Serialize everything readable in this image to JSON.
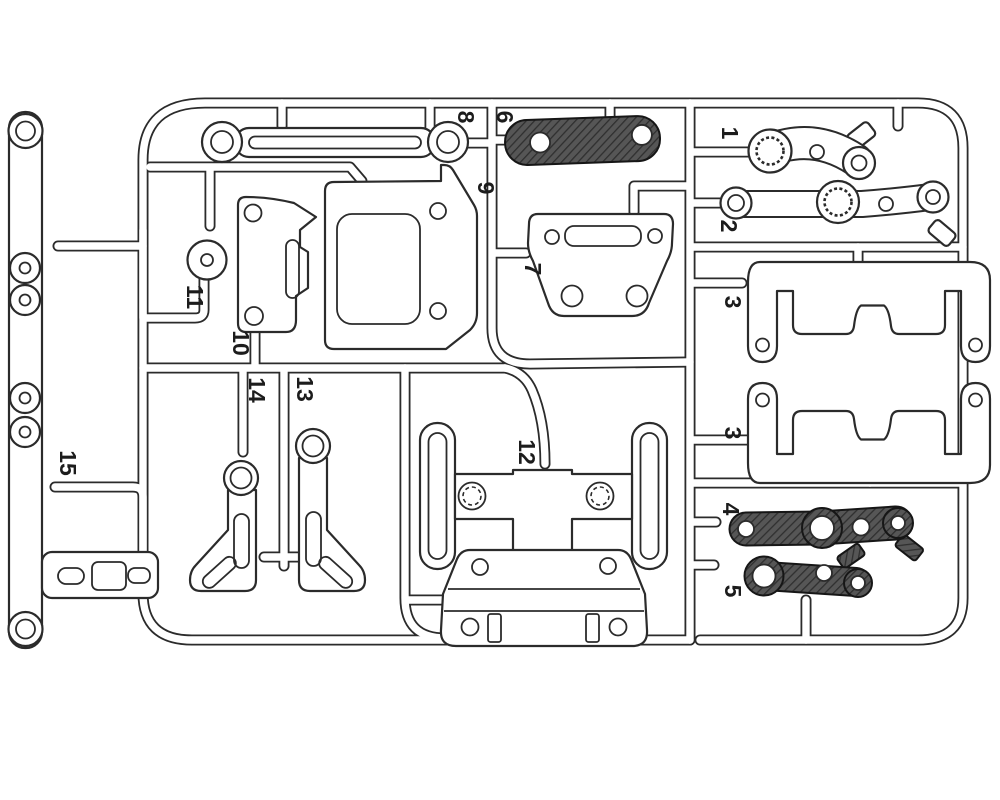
{
  "diagram": {
    "kind": "injection-molded parts sprue illustration",
    "background_color": "#ffffff",
    "line_color": "#2b2b2b",
    "dark_part_fill": "#565656",
    "dark_part_hatch": "#2f2f2f"
  },
  "part_labels": [
    {
      "text": "1"
    },
    {
      "text": "2"
    },
    {
      "text": "3"
    },
    {
      "text": "3"
    },
    {
      "text": "4"
    },
    {
      "text": "5"
    },
    {
      "text": "6"
    },
    {
      "text": "7"
    },
    {
      "text": "8"
    },
    {
      "text": "9"
    },
    {
      "text": "10"
    },
    {
      "text": "11"
    },
    {
      "text": "12"
    },
    {
      "text": "13"
    },
    {
      "text": "14"
    },
    {
      "text": "15"
    }
  ],
  "parts": [
    {
      "number": "1",
      "appearance": "outline",
      "label_count": 1
    },
    {
      "number": "2",
      "appearance": "outline",
      "label_count": 1
    },
    {
      "number": "3",
      "appearance": "outline",
      "label_count": 2
    },
    {
      "number": "4",
      "appearance": "dark-hatched",
      "label_count": 1
    },
    {
      "number": "5",
      "appearance": "dark-hatched",
      "label_count": 1
    },
    {
      "number": "6",
      "appearance": "dark-hatched",
      "label_count": 1
    },
    {
      "number": "7",
      "appearance": "outline",
      "label_count": 1
    },
    {
      "number": "8",
      "appearance": "outline",
      "label_count": 1
    },
    {
      "number": "9",
      "appearance": "outline",
      "label_count": 1
    },
    {
      "number": "10",
      "appearance": "outline",
      "label_count": 1
    },
    {
      "number": "11",
      "appearance": "outline",
      "label_count": 1
    },
    {
      "number": "12",
      "appearance": "outline",
      "label_count": 1
    },
    {
      "number": "13",
      "appearance": "outline",
      "label_count": 1
    },
    {
      "number": "14",
      "appearance": "outline",
      "label_count": 1
    },
    {
      "number": "15",
      "appearance": "outline",
      "label_count": 1
    }
  ]
}
